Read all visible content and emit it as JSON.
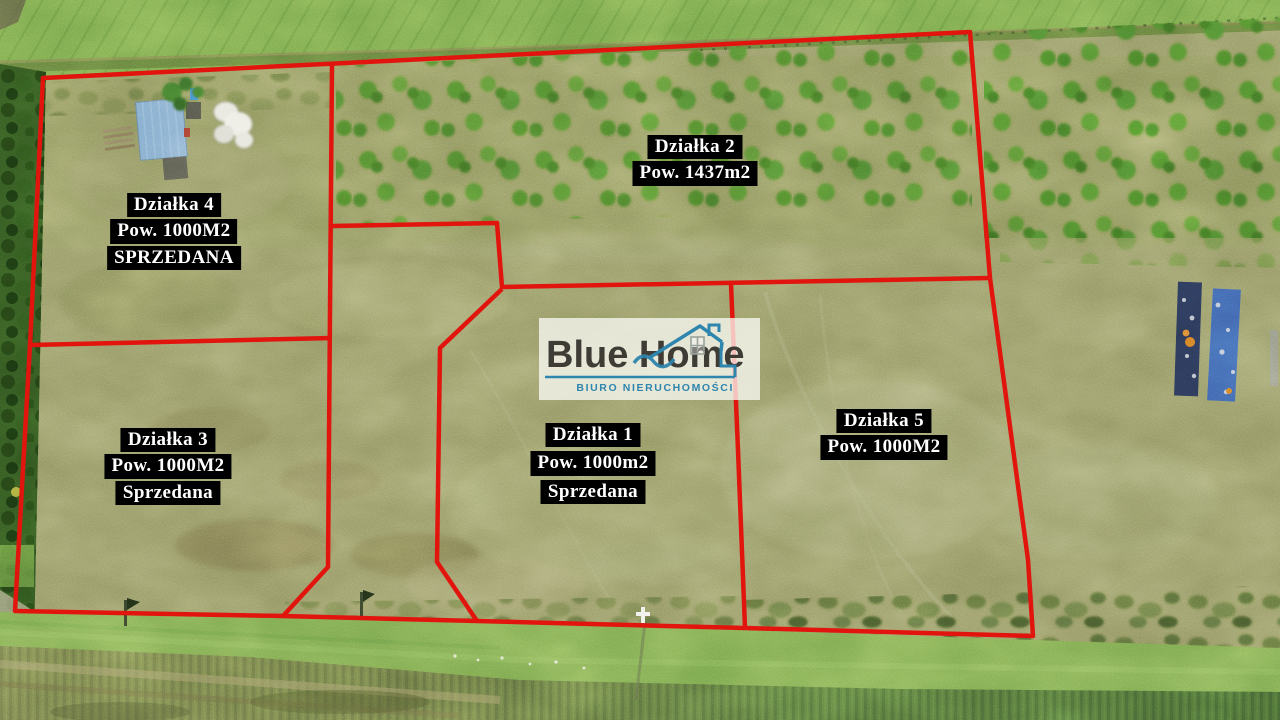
{
  "colors": {
    "boundary_red": "#e2150e",
    "label_background": "#000000",
    "label_text": "#ffffff",
    "logo_accent_teal": "#2e85ad",
    "logo_text_dark": "#3f3c36"
  },
  "watermark": {
    "brand": "Blue Home",
    "subtitle": "BIURO NIERUCHOMOŚCI"
  },
  "parcels": [
    {
      "id": "dzialka-2",
      "lines": [
        "Działka 2",
        "Pow. 1437m2"
      ]
    },
    {
      "id": "dzialka-4",
      "lines": [
        "Działka 4",
        "Pow. 1000M2",
        "SPRZEDANA"
      ]
    },
    {
      "id": "dzialka-3",
      "lines": [
        "Działka 3",
        "Pow. 1000M2",
        "Sprzedana"
      ]
    },
    {
      "id": "dzialka-1",
      "lines": [
        "Działka 1",
        "Pow. 1000m2",
        "Sprzedana"
      ]
    },
    {
      "id": "dzialka-5",
      "lines": [
        "Działka 5",
        "Pow. 1000M2"
      ]
    }
  ]
}
